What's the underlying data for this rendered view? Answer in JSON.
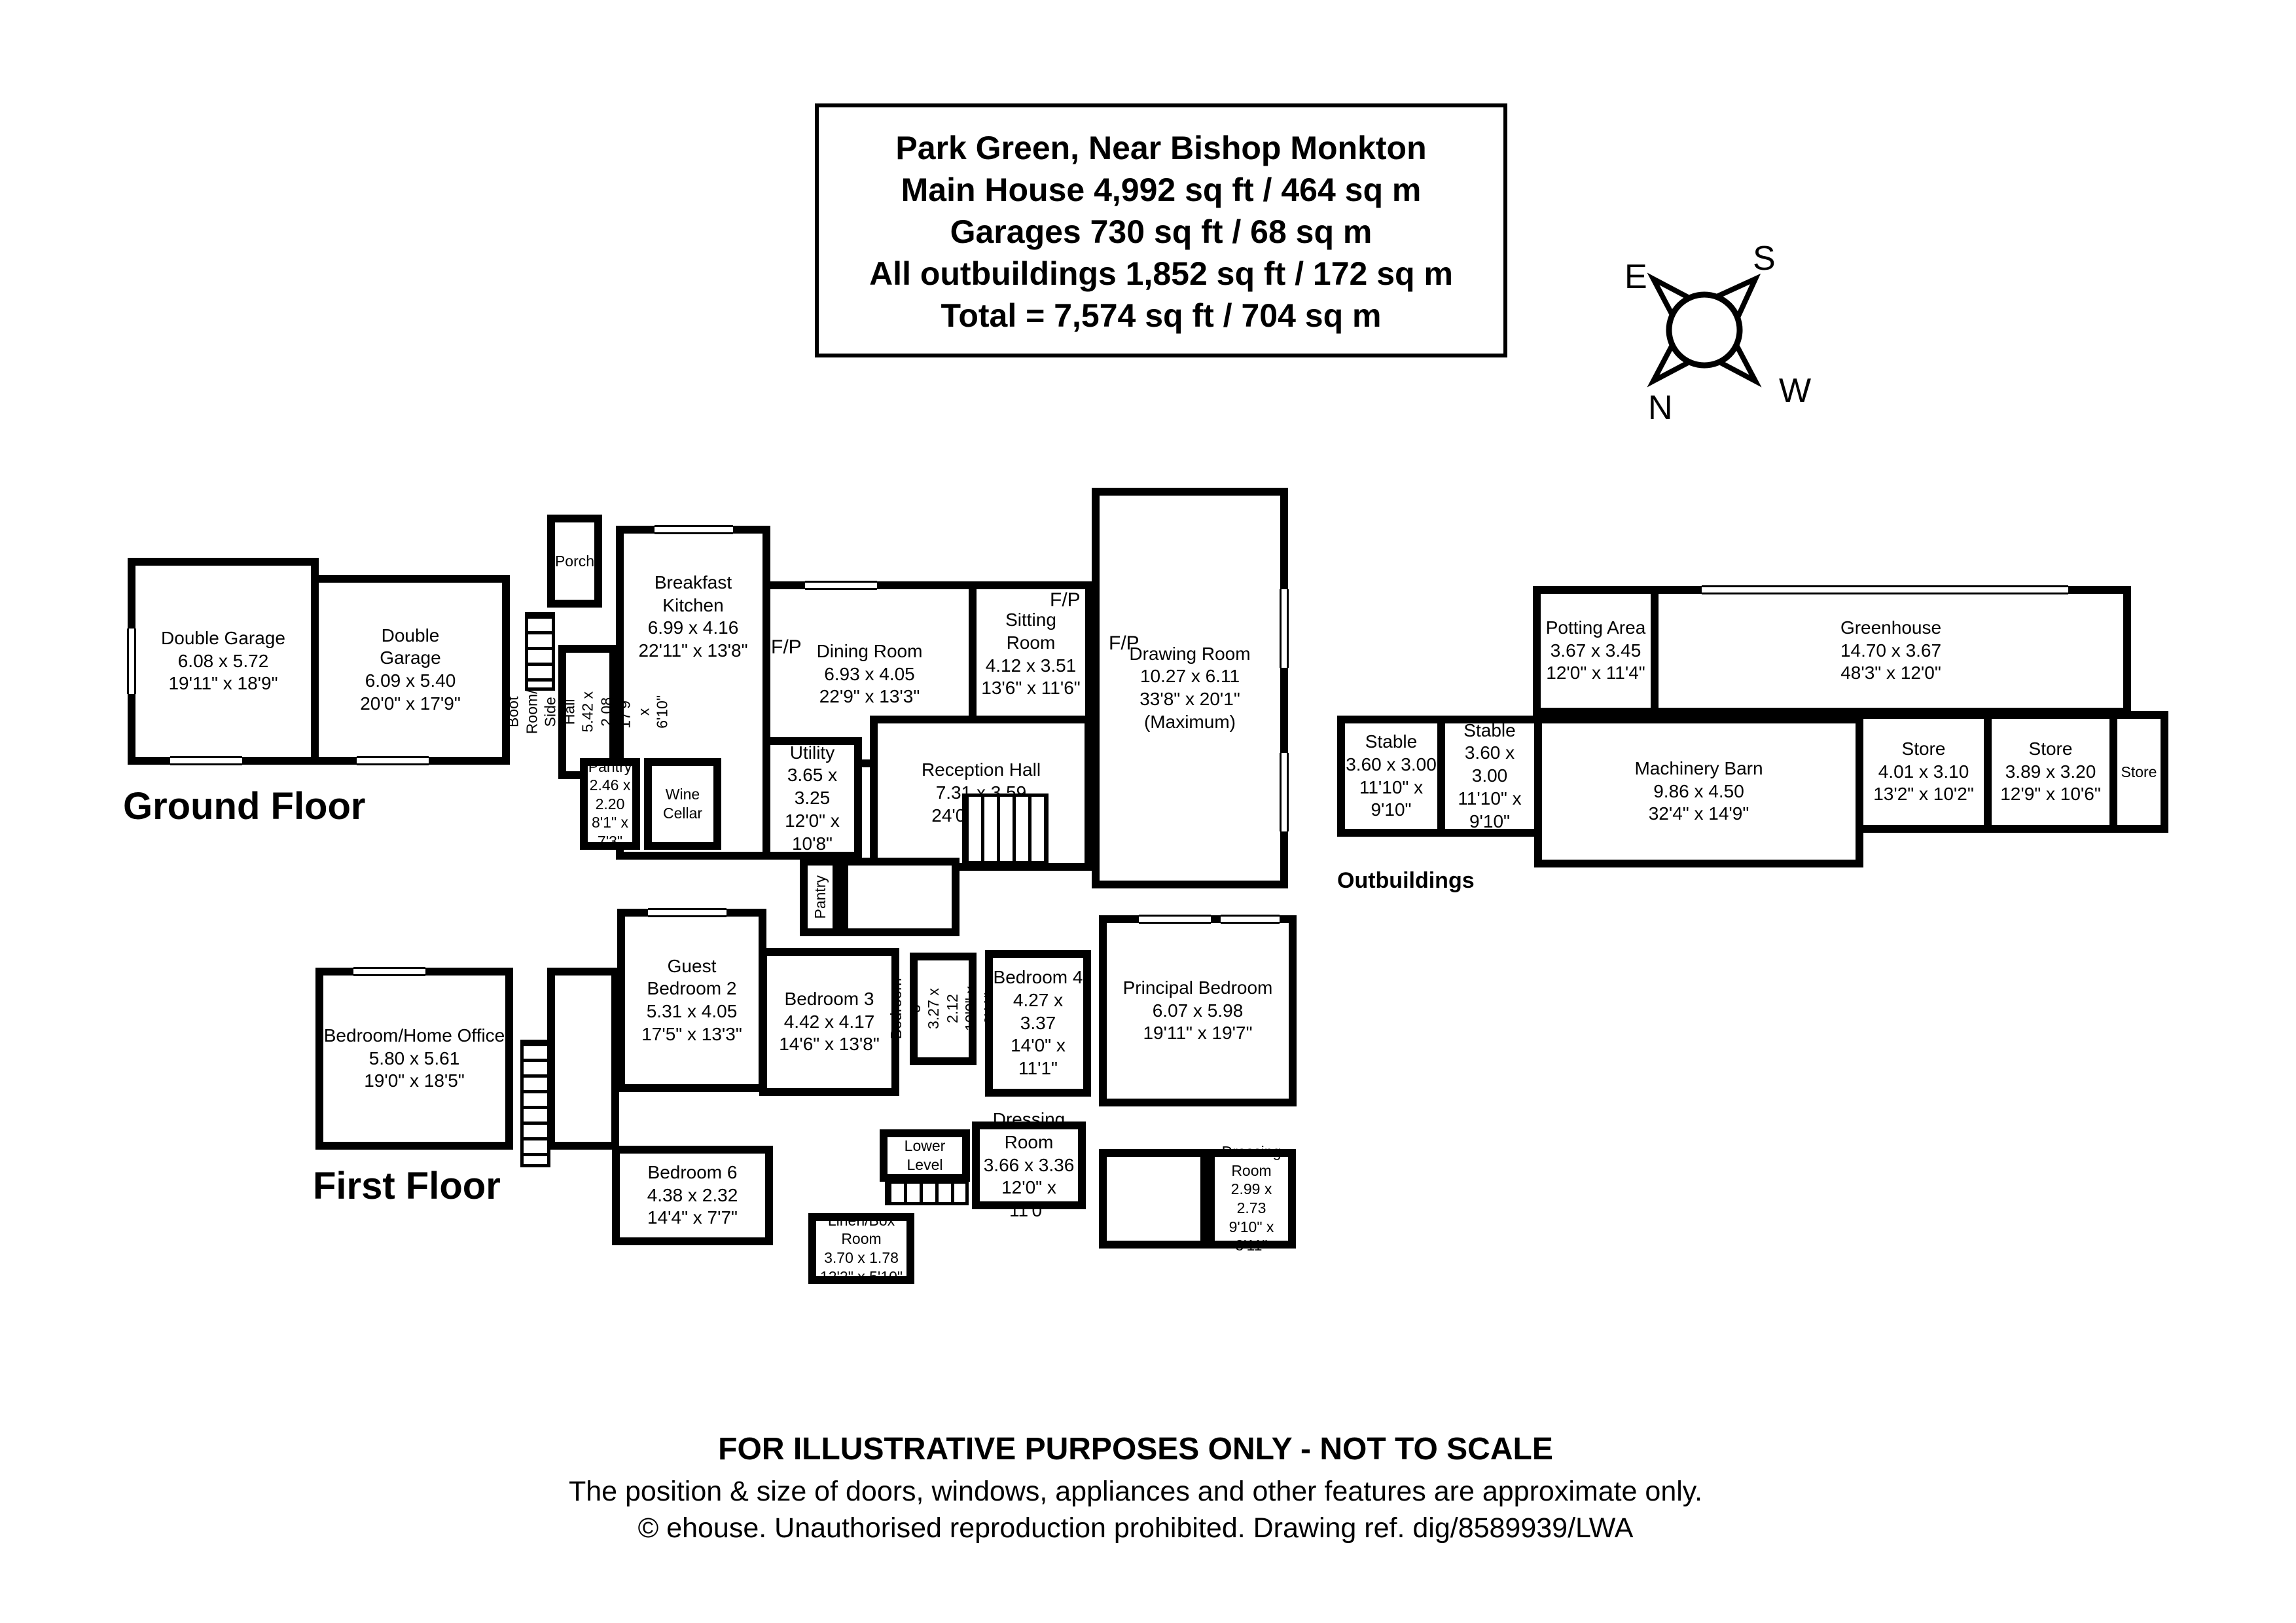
{
  "title_box": {
    "lines": [
      "Park Green, Near Bishop Monkton",
      "Main House 4,992 sq ft / 464 sq m",
      "Garages 730 sq ft / 68 sq m",
      "All outbuildings 1,852 sq ft / 172 sq m",
      "Total = 7,574 sq ft / 704 sq m"
    ]
  },
  "compass": {
    "north": "N",
    "south": "S",
    "east": "E",
    "west": "W"
  },
  "labels": {
    "ground_floor": "Ground Floor",
    "first_floor": "First Floor",
    "outbuildings": "Outbuildings",
    "fireplace": "F/P"
  },
  "rooms": {
    "double_garage_1": {
      "name": "Double Garage",
      "metric": "6.08 x 5.72",
      "imperial": "19'11\" x 18'9\""
    },
    "double_garage_2": {
      "name": "Double\nGarage",
      "metric": "6.09 x 5.40",
      "imperial": "20'0\" x 17'9\""
    },
    "porch": {
      "name": "Porch"
    },
    "breakfast_kitchen": {
      "name": "Breakfast Kitchen",
      "metric": "6.99 x 4.16",
      "imperial": "22'11\" x 13'8\""
    },
    "boot_room": {
      "name": "Boot Room/\nSide Hall",
      "metric": "5.42 x 2.08",
      "imperial": "17'9\" x 6'10\""
    },
    "pantry_1": {
      "name": "Pantry",
      "metric": "2.46 x 2.20",
      "imperial": "8'1\" x 7'3\""
    },
    "wine_cellar": {
      "name": "Wine\nCellar"
    },
    "dining_room": {
      "name": "Dining Room",
      "metric": "6.93 x 4.05",
      "imperial": "22'9\" x 13'3\""
    },
    "sitting_room": {
      "name": "Sitting\nRoom",
      "metric": "4.12 x 3.51",
      "imperial": "13'6\" x 11'6\""
    },
    "drawing_room": {
      "name": "Drawing Room",
      "metric": "10.27 x 6.11",
      "imperial": "33'8\" x 20'1\"",
      "note": "(Maximum)"
    },
    "utility": {
      "name": "Utility",
      "metric": "3.65 x 3.25",
      "imperial": "12'0\" x 10'8\""
    },
    "reception_hall": {
      "name": "Reception Hall",
      "metric": "7.31 x 3.59",
      "imperial": "24'0\" x 11'9\""
    },
    "pantry_2": {
      "name": "Pantry"
    },
    "potting_area": {
      "name": "Potting Area",
      "metric": "3.67 x 3.45",
      "imperial": "12'0\" x 11'4\""
    },
    "greenhouse": {
      "name": "Greenhouse",
      "metric": "14.70 x 3.67",
      "imperial": "48'3\" x 12'0\""
    },
    "stable_1": {
      "name": "Stable",
      "metric": "3.60 x 3.00",
      "imperial": "11'10\" x 9'10\""
    },
    "stable_2": {
      "name": "Stable",
      "metric": "3.60 x 3.00",
      "imperial": "11'10\" x 9'10\""
    },
    "machinery_barn": {
      "name": "Machinery Barn",
      "metric": "9.86 x 4.50",
      "imperial": "32'4\" x 14'9\""
    },
    "store_1": {
      "name": "Store",
      "metric": "4.01 x 3.10",
      "imperial": "13'2\" x 10'2\""
    },
    "store_2": {
      "name": "Store",
      "metric": "3.89 x 3.20",
      "imperial": "12'9\" x 10'6\""
    },
    "store_3": {
      "name": "Store"
    },
    "bedroom_home_office": {
      "name": "Bedroom/Home Office",
      "metric": "5.80 x 5.61",
      "imperial": "19'0\" x 18'5\""
    },
    "guest_bedroom_2": {
      "name": "Guest\nBedroom 2",
      "metric": "5.31 x 4.05",
      "imperial": "17'5\" x 13'3\""
    },
    "bedroom_3": {
      "name": "Bedroom 3",
      "metric": "4.42 x 4.17",
      "imperial": "14'6\" x 13'8\""
    },
    "bedroom_5": {
      "name": "Bedroom 5",
      "metric": "3.27 x 2.12",
      "imperial": "10'9\" x 6'11\""
    },
    "bedroom_4": {
      "name": "Bedroom 4",
      "metric": "4.27 x 3.37",
      "imperial": "14'0\" x 11'1\""
    },
    "principal_bedroom": {
      "name": "Principal Bedroom",
      "metric": "6.07 x 5.98",
      "imperial": "19'11\" x 19'7\""
    },
    "bedroom_6": {
      "name": "Bedroom 6",
      "metric": "4.38 x 2.32",
      "imperial": "14'4\" x 7'7\""
    },
    "lower_level": {
      "name": "Lower\nLevel"
    },
    "dressing_room_1": {
      "name": "Dressing Room",
      "metric": "3.66 x 3.36",
      "imperial": "12'0\" x 11'0\""
    },
    "dressing_room_2": {
      "name": "Dressing\nRoom",
      "metric": "2.99 x 2.73",
      "imperial": "9'10\" x 8'11\""
    },
    "linen_box_room": {
      "name": "Linen/Box Room",
      "metric": "3.70 x 1.78",
      "imperial": "12'2\" x 5'10\""
    }
  },
  "footer": {
    "line1": "FOR ILLUSTRATIVE PURPOSES ONLY - NOT TO SCALE",
    "line2": "The position & size of doors, windows, appliances and other features are approximate only.",
    "line3": "© ehouse. Unauthorised reproduction prohibited. Drawing ref. dig/8589939/LWA"
  }
}
